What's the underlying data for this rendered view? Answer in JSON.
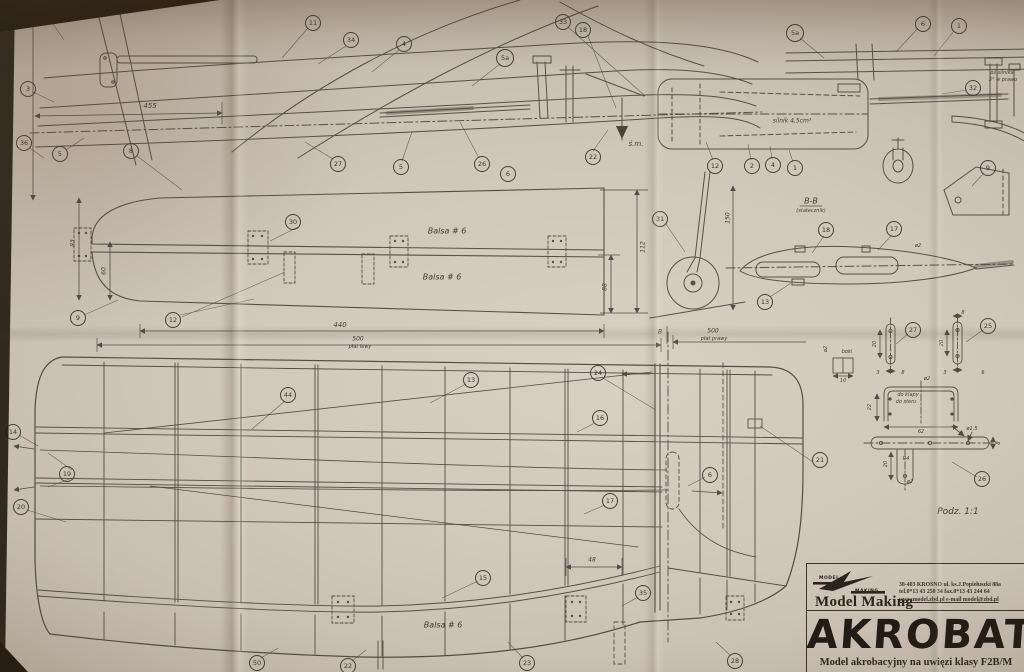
{
  "title_block": {
    "brand_top": "MODEL",
    "brand_bottom": "MAKING",
    "company": "Model Making",
    "address1": "38-403 KROSNO ul. ks.J.Popiełuszki 88a",
    "address2": "tel.0*13 43 250 34   fax.0*13 43 244 64",
    "address3": "www.model.zbd.pl   e-mail model@zbd.pl",
    "title": "AKROBAT",
    "subtitle": "Model akrobacyjny na uwięzi klasy F2B/M"
  },
  "annotations": {
    "scale_note": "Podz. 1:1",
    "section_label": "B-B",
    "cg_label": "ś.m.",
    "engine_note": "silnik 4,5cm³"
  },
  "callouts": [
    {
      "t": "6a",
      "x": 42,
      "y": 11,
      "s": 16
    },
    {
      "t": "3",
      "x": 28,
      "y": 89
    },
    {
      "t": "36",
      "x": 24,
      "y": 143
    },
    {
      "t": "5",
      "x": 60,
      "y": 154
    },
    {
      "t": "8",
      "x": 131,
      "y": 151
    },
    {
      "t": "11",
      "x": 313,
      "y": 23
    },
    {
      "t": "34",
      "x": 351,
      "y": 40
    },
    {
      "t": "4",
      "x": 404,
      "y": 44
    },
    {
      "t": "5a",
      "x": 505,
      "y": 58,
      "s": 16
    },
    {
      "t": "33",
      "x": 563,
      "y": 22
    },
    {
      "t": "18",
      "x": 583,
      "y": 30
    },
    {
      "t": "27",
      "x": 338,
      "y": 164
    },
    {
      "t": "5",
      "x": 401,
      "y": 167
    },
    {
      "t": "26",
      "x": 482,
      "y": 164
    },
    {
      "t": "6",
      "x": 508,
      "y": 174
    },
    {
      "t": "22",
      "x": 593,
      "y": 157
    },
    {
      "t": "5a",
      "x": 795,
      "y": 33,
      "s": 16
    },
    {
      "t": "6",
      "x": 923,
      "y": 24
    },
    {
      "t": "1",
      "x": 959,
      "y": 26
    },
    {
      "t": "32",
      "x": 973,
      "y": 88
    },
    {
      "t": "12",
      "x": 715,
      "y": 166
    },
    {
      "t": "2",
      "x": 752,
      "y": 166
    },
    {
      "t": "4",
      "x": 773,
      "y": 165
    },
    {
      "t": "1",
      "x": 795,
      "y": 168
    },
    {
      "t": "9",
      "x": 988,
      "y": 168
    },
    {
      "t": "31",
      "x": 660,
      "y": 219
    },
    {
      "t": "30",
      "x": 293,
      "y": 222
    },
    {
      "t": "9",
      "x": 78,
      "y": 318
    },
    {
      "t": "12",
      "x": 173,
      "y": 320
    },
    {
      "t": "13",
      "x": 765,
      "y": 302
    },
    {
      "t": "18",
      "x": 826,
      "y": 230
    },
    {
      "t": "17",
      "x": 894,
      "y": 229
    },
    {
      "t": "27",
      "x": 913,
      "y": 330
    },
    {
      "t": "25",
      "x": 988,
      "y": 326
    },
    {
      "t": "26",
      "x": 982,
      "y": 479
    },
    {
      "t": "14",
      "x": 13,
      "y": 432
    },
    {
      "t": "19",
      "x": 67,
      "y": 474
    },
    {
      "t": "20",
      "x": 21,
      "y": 507
    },
    {
      "t": "44",
      "x": 288,
      "y": 395
    },
    {
      "t": "13",
      "x": 471,
      "y": 380
    },
    {
      "t": "24",
      "x": 598,
      "y": 373
    },
    {
      "t": "16",
      "x": 600,
      "y": 418
    },
    {
      "t": "17",
      "x": 610,
      "y": 501
    },
    {
      "t": "6",
      "x": 710,
      "y": 475
    },
    {
      "t": "21",
      "x": 820,
      "y": 460
    },
    {
      "t": "15",
      "x": 483,
      "y": 578
    },
    {
      "t": "35",
      "x": 643,
      "y": 593
    },
    {
      "t": "50",
      "x": 257,
      "y": 663
    },
    {
      "t": "22",
      "x": 348,
      "y": 666
    },
    {
      "t": "23",
      "x": 527,
      "y": 663
    },
    {
      "t": "28",
      "x": 735,
      "y": 661
    }
  ],
  "labels": [
    {
      "t": "455",
      "x": 150,
      "y": 106
    },
    {
      "t": "125",
      "x": 28,
      "y": 22,
      "r": -78,
      "s": 6
    },
    {
      "t": "ś.m.",
      "x": 636,
      "y": 144
    },
    {
      "t": "silnik 4,5cm³",
      "x": 792,
      "y": 121,
      "s": 6
    },
    {
      "t": "oś silnika",
      "x": 1002,
      "y": 73,
      "s": 5
    },
    {
      "t": "3° w prawo",
      "x": 1003,
      "y": 80,
      "s": 5
    },
    {
      "t": "B-B",
      "x": 811,
      "y": 201,
      "s": 8
    },
    {
      "t": "(statecznik)",
      "x": 811,
      "y": 211,
      "s": 5
    },
    {
      "t": "Balsa # 6",
      "x": 447,
      "y": 231,
      "s": 8
    },
    {
      "t": "Balsa # 6",
      "x": 442,
      "y": 277,
      "s": 8
    },
    {
      "t": "Balsa # 6",
      "x": 443,
      "y": 625,
      "s": 8
    },
    {
      "t": "83",
      "x": 73,
      "y": 243,
      "r": -90,
      "s": 6
    },
    {
      "t": "60",
      "x": 104,
      "y": 271,
      "r": -90,
      "s": 6
    },
    {
      "t": "112",
      "x": 643,
      "y": 247,
      "r": -90,
      "s": 6
    },
    {
      "t": "88",
      "x": 605,
      "y": 287,
      "r": -90,
      "s": 6
    },
    {
      "t": "440",
      "x": 340,
      "y": 325
    },
    {
      "t": "500",
      "x": 358,
      "y": 339,
      "s": 6
    },
    {
      "t": "płat lewy",
      "x": 360,
      "y": 347,
      "s": 5
    },
    {
      "t": "500",
      "x": 713,
      "y": 331,
      "s": 6
    },
    {
      "t": "płat prawy",
      "x": 714,
      "y": 339,
      "s": 5
    },
    {
      "t": "B",
      "x": 660,
      "y": 332,
      "s": 6
    },
    {
      "t": "150",
      "x": 728,
      "y": 218,
      "r": -90,
      "s": 6
    },
    {
      "t": "48",
      "x": 592,
      "y": 560,
      "s": 6
    },
    {
      "t": "ø2",
      "x": 918,
      "y": 246,
      "s": 5
    },
    {
      "t": "Podz. 1:1",
      "x": 958,
      "y": 512,
      "s": 9
    },
    {
      "t": "ø2",
      "x": 826,
      "y": 349,
      "r": -90,
      "s": 5
    },
    {
      "t": "boki",
      "x": 847,
      "y": 352,
      "s": 5
    },
    {
      "t": "10",
      "x": 843,
      "y": 381,
      "s": 5
    },
    {
      "t": "20",
      "x": 875,
      "y": 344,
      "r": -90,
      "s": 5
    },
    {
      "t": "3",
      "x": 878,
      "y": 373,
      "s": 5
    },
    {
      "t": "8",
      "x": 903,
      "y": 373,
      "s": 5
    },
    {
      "t": "8",
      "x": 963,
      "y": 313,
      "s": 5
    },
    {
      "t": "20",
      "x": 942,
      "y": 343,
      "r": -90,
      "s": 5
    },
    {
      "t": "3",
      "x": 945,
      "y": 373,
      "s": 5
    },
    {
      "t": "6",
      "x": 983,
      "y": 373,
      "s": 5
    },
    {
      "t": "ø2",
      "x": 927,
      "y": 379,
      "s": 5
    },
    {
      "t": "22",
      "x": 870,
      "y": 407,
      "r": -90,
      "s": 5
    },
    {
      "t": "62",
      "x": 921,
      "y": 432,
      "s": 5
    },
    {
      "t": "do klapy",
      "x": 908,
      "y": 395,
      "s": 5
    },
    {
      "t": "do steru",
      "x": 906,
      "y": 402,
      "s": 5
    },
    {
      "t": "ø1,5",
      "x": 972,
      "y": 429,
      "s": 5
    },
    {
      "t": "8",
      "x": 999,
      "y": 443,
      "r": -90,
      "s": 5
    },
    {
      "t": "R4",
      "x": 906,
      "y": 459,
      "s": 5
    },
    {
      "t": "20",
      "x": 886,
      "y": 464,
      "r": -90,
      "s": 5
    },
    {
      "t": "ø2",
      "x": 910,
      "y": 482,
      "s": 5
    }
  ]
}
